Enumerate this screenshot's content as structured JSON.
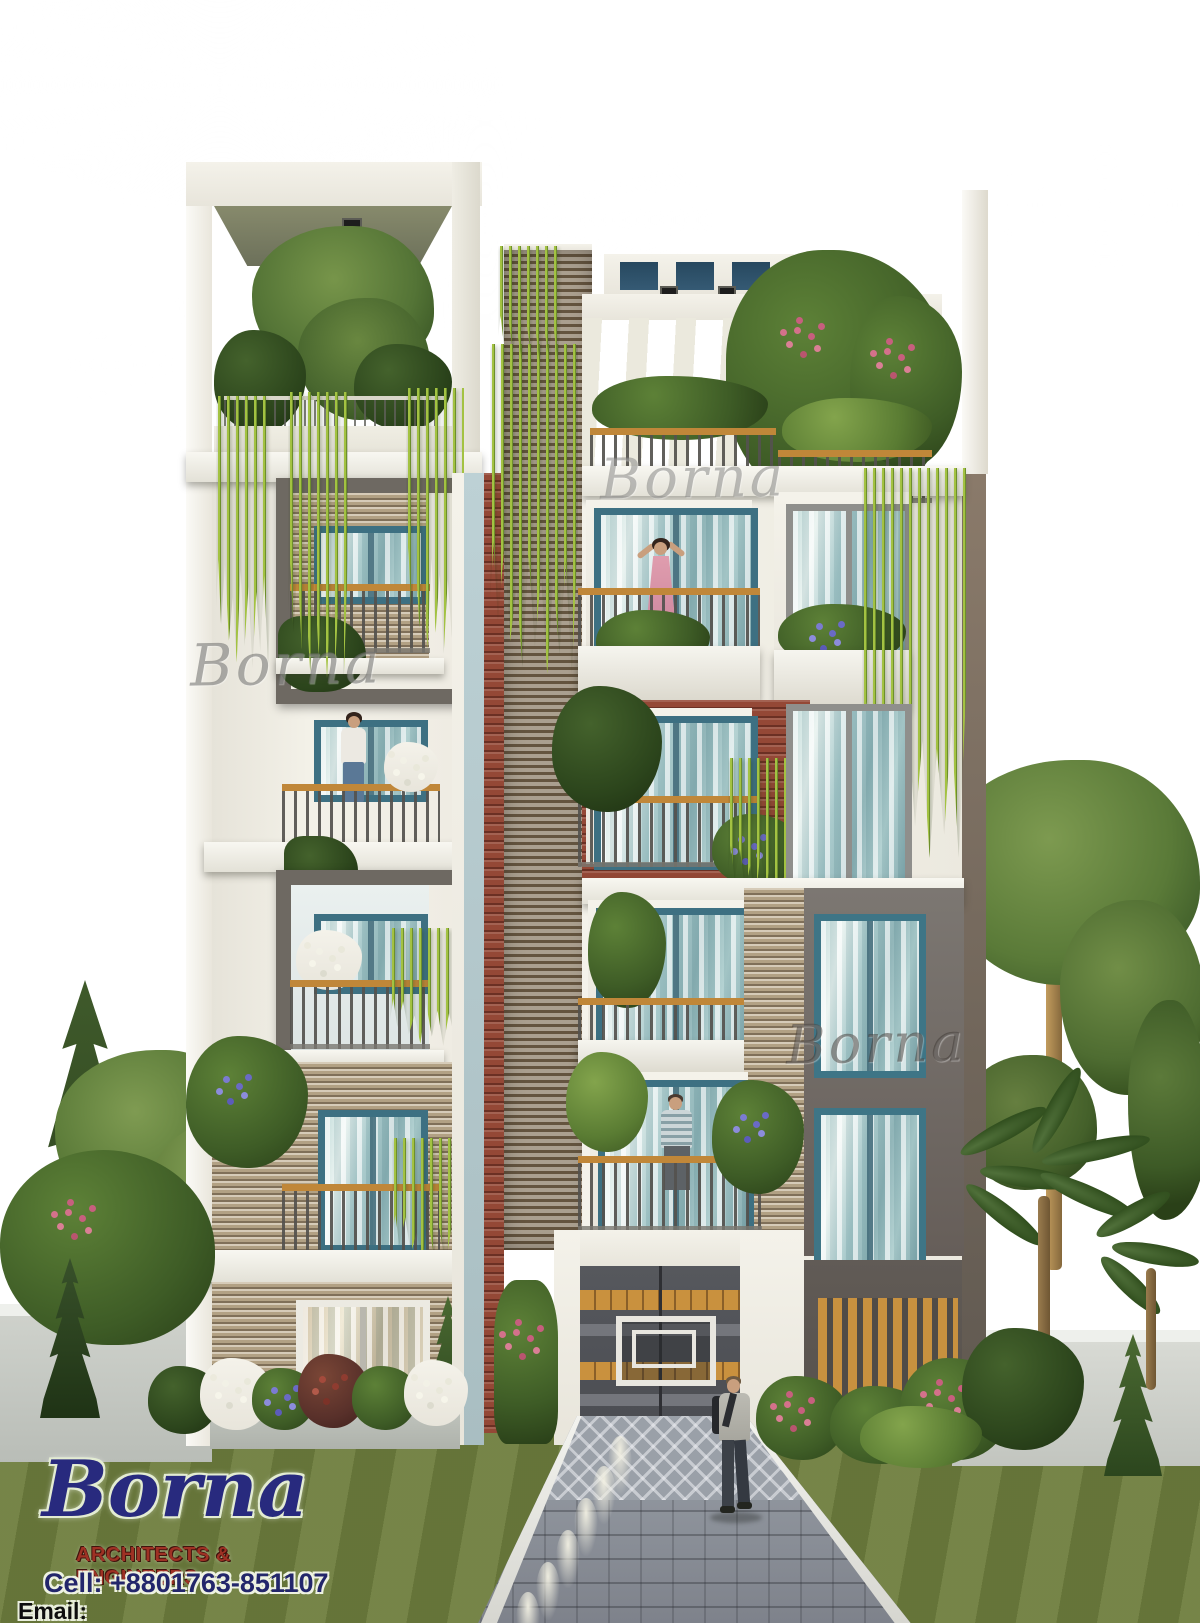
{
  "branding": {
    "logo_name": "Borna",
    "logo_tagline": "ARCHITECTS & ENGINEERS",
    "logo_cell": "Cell: +8801763-851107",
    "logo_email": "Email: bornaengineering@gmail.com"
  },
  "watermarks": {
    "text": "Borna"
  },
  "scene": {
    "description": "Front elevation 3D architectural rendering of a six-storey residential apartment building with planted balconies, rooftop pergola, central louvered core, landscaped garden walls and a paver driveway under a blue sky",
    "figures": [
      "woman on upper-left balcony",
      "woman in pink dress on fifth-floor balcony",
      "man on second-floor balcony",
      "man walking on the driveway"
    ],
    "floors_visible": 6
  },
  "colors": {
    "sky_top": "#2b6fb2",
    "sky_horizon": "#e3ebe3",
    "facade_white": "#f1eee6",
    "brick_red": "#944836",
    "brick_tan": "#b2a184",
    "louver_slat": "#aa9f8f",
    "accent_cyan": "#b9cdd1",
    "dark_gray_block": "#6e6965",
    "wood_rail": "#c08739",
    "window_teal": "#3d7082",
    "vine_green": "#9cbf3a",
    "foliage_green": "#4e7a33",
    "lawn_green": "#6d7d3d",
    "paver_gray": "#8f939c",
    "logo_navy": "#282a7e",
    "logo_red": "#9e3124"
  }
}
